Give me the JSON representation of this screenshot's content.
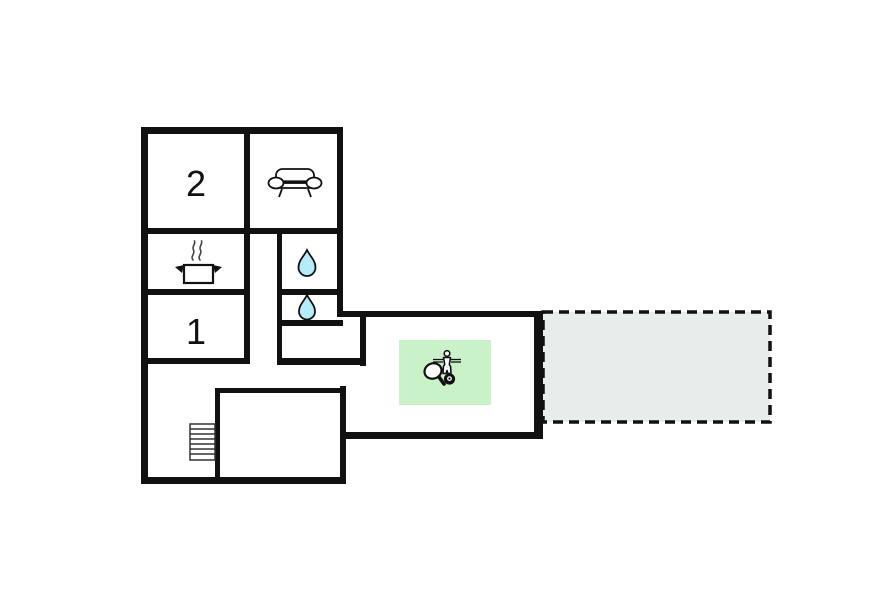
{
  "title": "Holiday home floor plan",
  "colors": {
    "wall": "#111111",
    "background": "#ffffff",
    "water_drop": "#b4edf9",
    "game_area": "#c9f2c9",
    "terrace": "#e8edeb",
    "icon_stroke": "#111111"
  },
  "rooms": {
    "bedroom_2": {
      "label": "2"
    },
    "bedroom_1": {
      "label": "1"
    },
    "living_room": {
      "icon": "sofa-icon"
    },
    "kitchen": {
      "icon": "cooking-pot-icon"
    },
    "bathroom_upper": {
      "icon": "water-drop-icon"
    },
    "bathroom_lower": {
      "icon": "water-drop-icon"
    },
    "game_room": {
      "icons": [
        "table-tennis-paddle-icon",
        "foosball-player-icon",
        "billiard-ball-icon"
      ]
    },
    "terrace": {
      "style": "dashed-outline"
    },
    "stairwell": {
      "icon": "stairs-icon"
    },
    "garage_void": {}
  }
}
